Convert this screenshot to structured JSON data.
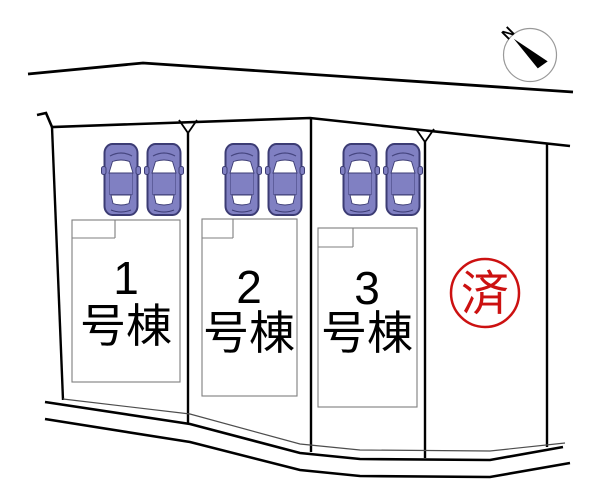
{
  "diagram": {
    "compass": {
      "label": "N"
    },
    "buildings": [
      {
        "number": "1",
        "suffix": "号棟"
      },
      {
        "number": "2",
        "suffix": "号棟"
      },
      {
        "number": "3",
        "suffix": "号棟"
      }
    ],
    "stamp": {
      "label": "済"
    },
    "cars": {
      "count": 6
    },
    "colors": {
      "line": "#000000",
      "building_outline": "#7f7f7f",
      "setback_line": "#4d4d4d",
      "car_body": "#8080c2",
      "car_outline": "#3c3c74",
      "car_window": "#ffffff",
      "stamp_red": "#cc1111",
      "compass_ring": "#999999",
      "background": "#ffffff"
    }
  }
}
